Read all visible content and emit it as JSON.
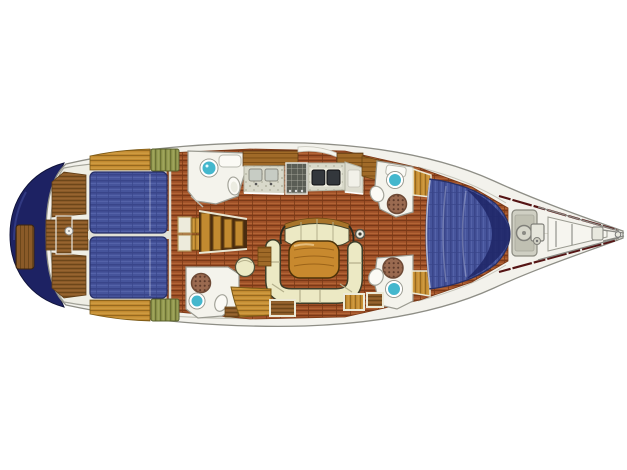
{
  "description": "Sailing yacht interior layout floor plan, top view, bow pointing right",
  "canvas": {
    "width": 627,
    "height": 470
  },
  "colors": {
    "canvas": "#ffffff",
    "hull_fill": "#f3f2ec",
    "hull_line": "#8e8e86",
    "trim_line": "#c6c5ba",
    "transom_navy": "#1d2263",
    "berth_blue": "#46549b",
    "berth_blue_dark": "#39458a",
    "berth_blue_light": "#5765ab",
    "berth_outline": "#272f66",
    "plank": "#9c4e26",
    "plank_dark": "#7a3917",
    "plank_light": "#bb6e3b",
    "teak": "#8a5a28",
    "teak_dark": "#684318",
    "teak_light": "#9f6b33",
    "gold_wood": "#c28a30",
    "gold_wood_dark": "#96691f",
    "gold_wood_light": "#d9a94f",
    "mid_wood": "#a06a28",
    "mid_wood_dark": "#7a4c15",
    "green_cushion": "#93994e",
    "green_cushion_dark": "#6b7134",
    "green_cushion_light": "#aab069",
    "cream": "#ece9c4",
    "cream_dark": "#b5b08c",
    "table_wood": "#c8892e",
    "fixture_white": "#f4f3ec",
    "fixture_line": "#9a9a90",
    "basin_teal": "#44b7cd",
    "grate_brown": "#9a6a50",
    "grate_dot": "#5e3a2a",
    "sink_steel": "#c7ccc4",
    "stove_gray": "#5a5d55",
    "stove_grid": "#c9c9be",
    "dark_sink": "#33373c",
    "counter": "#d9d9ca",
    "counter_dot": "#b2b2a0",
    "maroon": "#551414",
    "pulpit_gray": "#8a8a84"
  },
  "regions": [
    {
      "id": "transom",
      "label": "navy transom"
    },
    {
      "id": "swim-platform",
      "label": "teak swim platform step"
    },
    {
      "id": "hull-deck",
      "label": "hull and white side decks"
    },
    {
      "id": "cabin-sole",
      "label": "wood plank cabin sole"
    },
    {
      "id": "cockpit",
      "label": "cockpit with teak benches and sole"
    },
    {
      "id": "stern-lockers",
      "label": "side cabinetry with green slatted cushions"
    },
    {
      "id": "aft-berth-port",
      "label": "aft cabin double berth (port)"
    },
    {
      "id": "aft-berth-starboard",
      "label": "aft cabin double berth (starboard)"
    },
    {
      "id": "aft-head-port",
      "label": "aft head with washbasin and toilet"
    },
    {
      "id": "aft-head-starboard",
      "label": "aft shower room with drain grate, washbasin and toilet"
    },
    {
      "id": "companionway",
      "label": "companionway steps with lockers"
    },
    {
      "id": "galley",
      "label": "galley with twin sinks and stove"
    },
    {
      "id": "chart-table",
      "label": "chart table / nav station"
    },
    {
      "id": "saloon",
      "label": "saloon with bench, table, U-settee and pouf"
    },
    {
      "id": "forward-head-port",
      "label": "forward head (port) with basin, toilet and shower grate"
    },
    {
      "id": "forward-head-starboard",
      "label": "forward head (starboard) with shower grate, basin and toilet"
    },
    {
      "id": "v-berth",
      "label": "forward cabin V-berth"
    },
    {
      "id": "anchor-locker",
      "label": "anchor locker hatch"
    },
    {
      "id": "bow-pulpit",
      "label": "bow pulpit, toe rails and windlass"
    },
    {
      "id": "mast",
      "label": "mast post"
    }
  ]
}
